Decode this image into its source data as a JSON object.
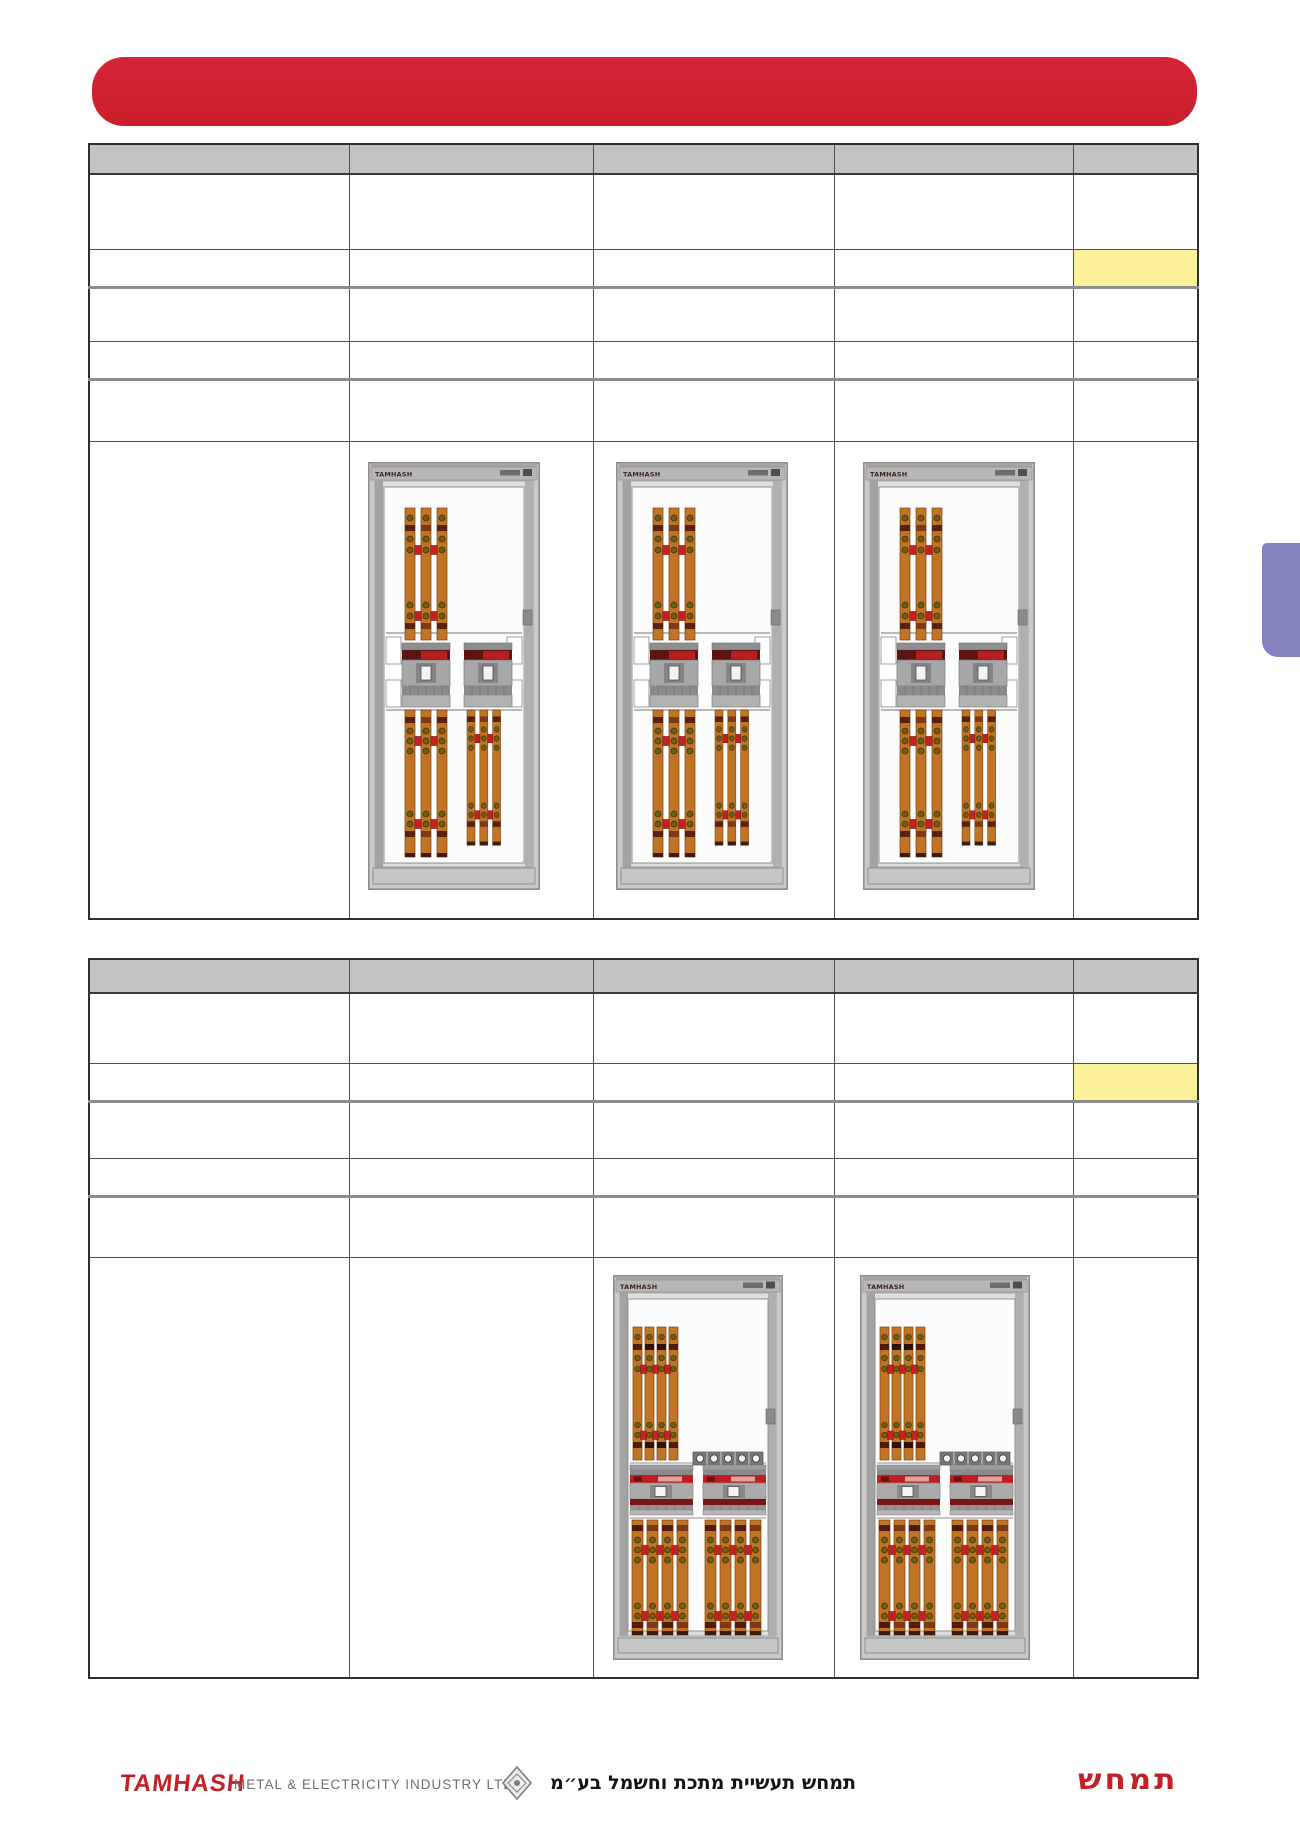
{
  "header_bar": {
    "label": "",
    "color": "#cc2030"
  },
  "side_tab": {
    "color": "#8583bf"
  },
  "tables": {
    "header_bg": "#c2c3c5",
    "highlight_color": "#fbf19a",
    "table1": {
      "columns": 5,
      "data_rows": 5,
      "highlight": {
        "row": 2,
        "column": 5
      },
      "panel_images": 3,
      "cells_text": ""
    },
    "table2": {
      "columns": 5,
      "data_rows": 5,
      "highlight": {
        "row": 2,
        "column": 5
      },
      "panel_images": 2,
      "cells_text": ""
    }
  },
  "panel": {
    "brand": "TAMHASH",
    "busbar_color": "#c17423",
    "accent_red": "#b91e1c",
    "frame_gray": "#c9c9c9"
  },
  "footer": {
    "logo_text": "TAMHASH",
    "company_text": "METAL & ELECTRICITY  INDUSTRY  LTD",
    "hebrew_text": "תמחש תעשיית מתכת וחשמל בע״מ",
    "hebrew_logo_text": "תמחש"
  }
}
